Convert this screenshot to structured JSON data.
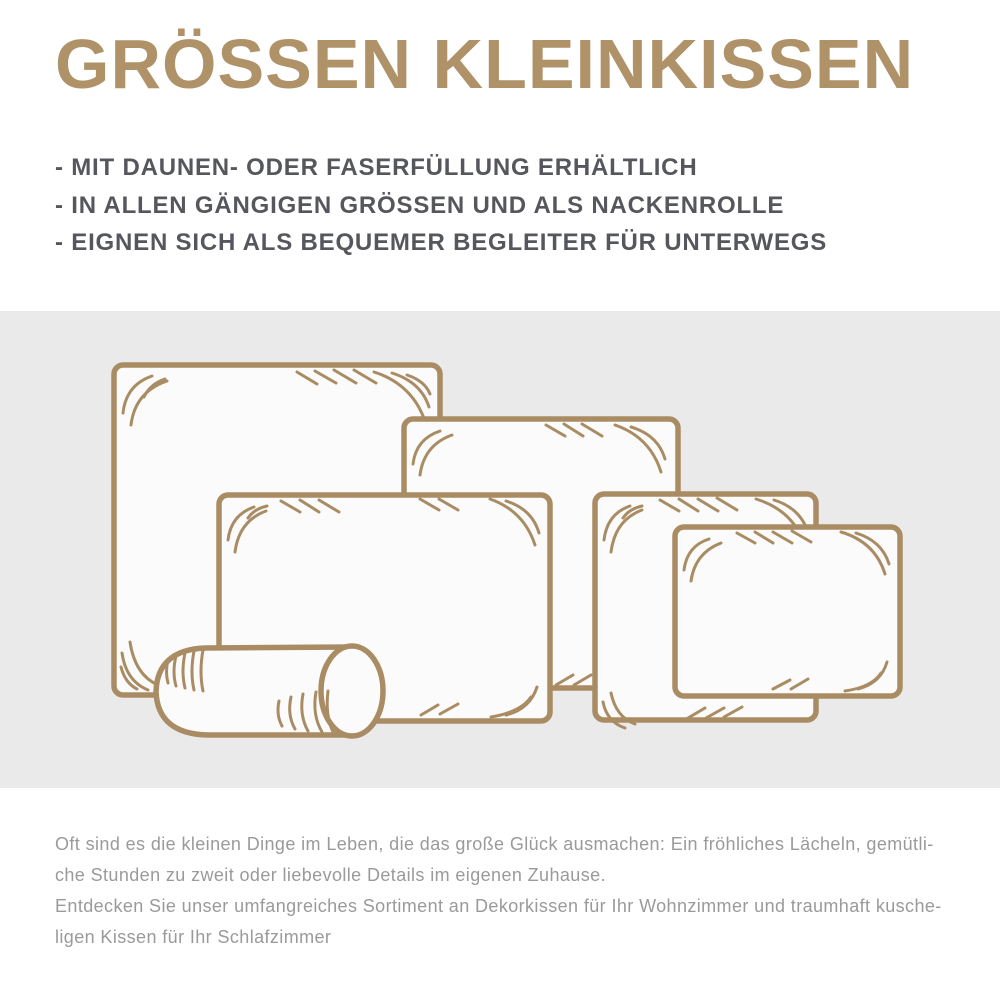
{
  "header": {
    "title": "GRÖSSEN KLEINKISSEN",
    "title_color": "#af9268",
    "bullets": [
      "- MIT DAUNEN- ODER FASERFÜLLUNG ERHÄLTLICH",
      "- IN ALLEN GÄNGIGEN GRÖSSEN UND ALS NACKENROLLE",
      "- EIGNEN SICH ALS BEQUEMER BEGLEITER FÜR UNTERWEGS"
    ],
    "bullet_color": "#55575c"
  },
  "illustration": {
    "panel_background": "#eaeaea",
    "outline_color": "#a98c63",
    "pillow_fill_color": "#fbfbfb",
    "items": [
      {
        "name": "large-square-pillow-icon"
      },
      {
        "name": "tall-pillow-icon"
      },
      {
        "name": "wide-rectangle-pillow-icon"
      },
      {
        "name": "medium-pillow-icon"
      },
      {
        "name": "small-pillow-icon"
      },
      {
        "name": "neck-roll-icon"
      }
    ]
  },
  "description": {
    "text_color": "#9a9a9a",
    "lines": [
      "Oft sind es die kleinen Dinge im Leben, die das große Glück ausmachen: Ein fröhliches Lächeln, gemütli-",
      "che Stunden zu zweit oder liebevolle Details im eigenen Zuhause.",
      "Entdecken Sie unser umfangreiches Sortiment an Dekorkissen für Ihr Wohnzimmer und traumhaft kusche-",
      "ligen Kissen für Ihr Schlafzimmer"
    ]
  }
}
